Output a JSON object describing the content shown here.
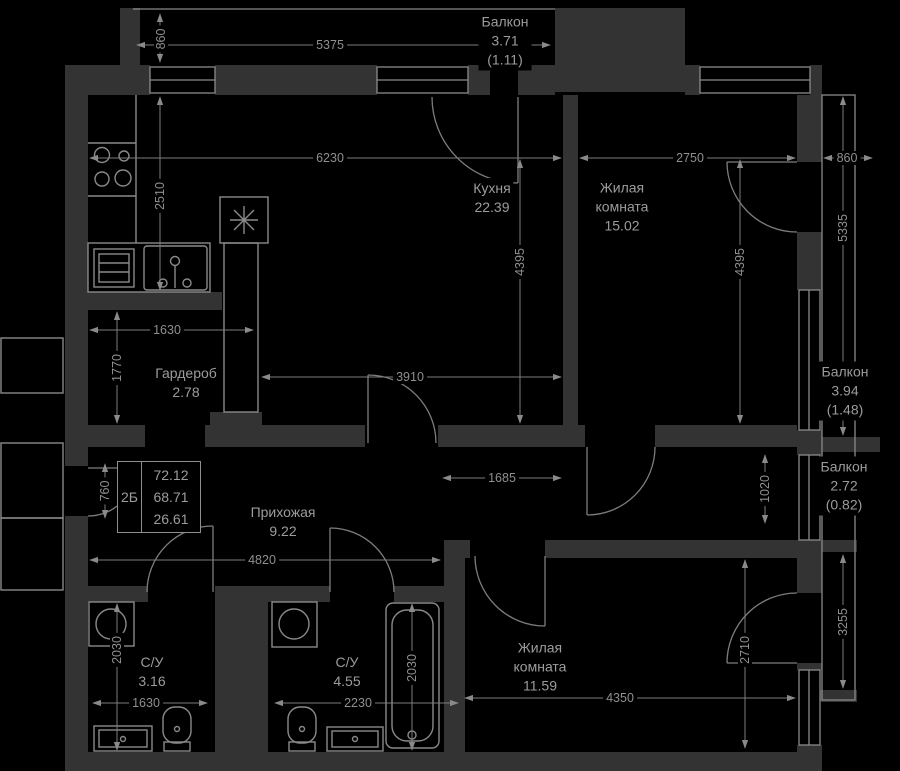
{
  "floorplan": {
    "unit": {
      "code": "2Б",
      "area_total": "72.12",
      "area_usable": "68.71",
      "area_living": "26.61"
    },
    "rooms": {
      "kitchen": {
        "name": "Кухня",
        "area": "22.39"
      },
      "living1": {
        "name_line1": "Жилая",
        "name_line2": "комната",
        "area": "15.02"
      },
      "living2": {
        "name_line1": "Жилая",
        "name_line2": "комната",
        "area": "11.59"
      },
      "wardrobe": {
        "name": "Гардероб",
        "area": "2.78"
      },
      "hall": {
        "name": "Прихожая",
        "area": "9.22"
      },
      "bath1": {
        "name": "С/У",
        "area": "3.16"
      },
      "bath2": {
        "name": "С/У",
        "area": "4.55"
      },
      "balcony_top": {
        "name": "Балкон",
        "area": "3.71",
        "area_reduced": "(1.11)"
      },
      "balcony_right_upper": {
        "name": "Балкон",
        "area": "3.94",
        "area_reduced": "(1.48)"
      },
      "balcony_right_lower": {
        "name": "Балкон",
        "area": "2.72",
        "area_reduced": "(0.82)"
      }
    },
    "dimensions": {
      "top_width": "5375",
      "top_balcony_depth": "860",
      "kitchen_width": "6230",
      "living1_width": "2750",
      "right_balcony_depth": "860",
      "kitchen_left_height": "2510",
      "kitchen_height": "4395",
      "living1_height": "4395",
      "right_upper_height": "5335",
      "wardrobe_width": "1630",
      "wardrobe_height": "1770",
      "kitchen_inner_width": "3910",
      "hall_nook_width": "1685",
      "hall_nook_height": "1020",
      "entry_opening": "760",
      "hall_width": "4820",
      "bath1_height": "2030",
      "bath1_width": "1630",
      "bath2_width": "2230",
      "bath2_height": "2030",
      "living2_width": "4350",
      "living2_height": "2710",
      "right_lower_height": "3255"
    }
  }
}
